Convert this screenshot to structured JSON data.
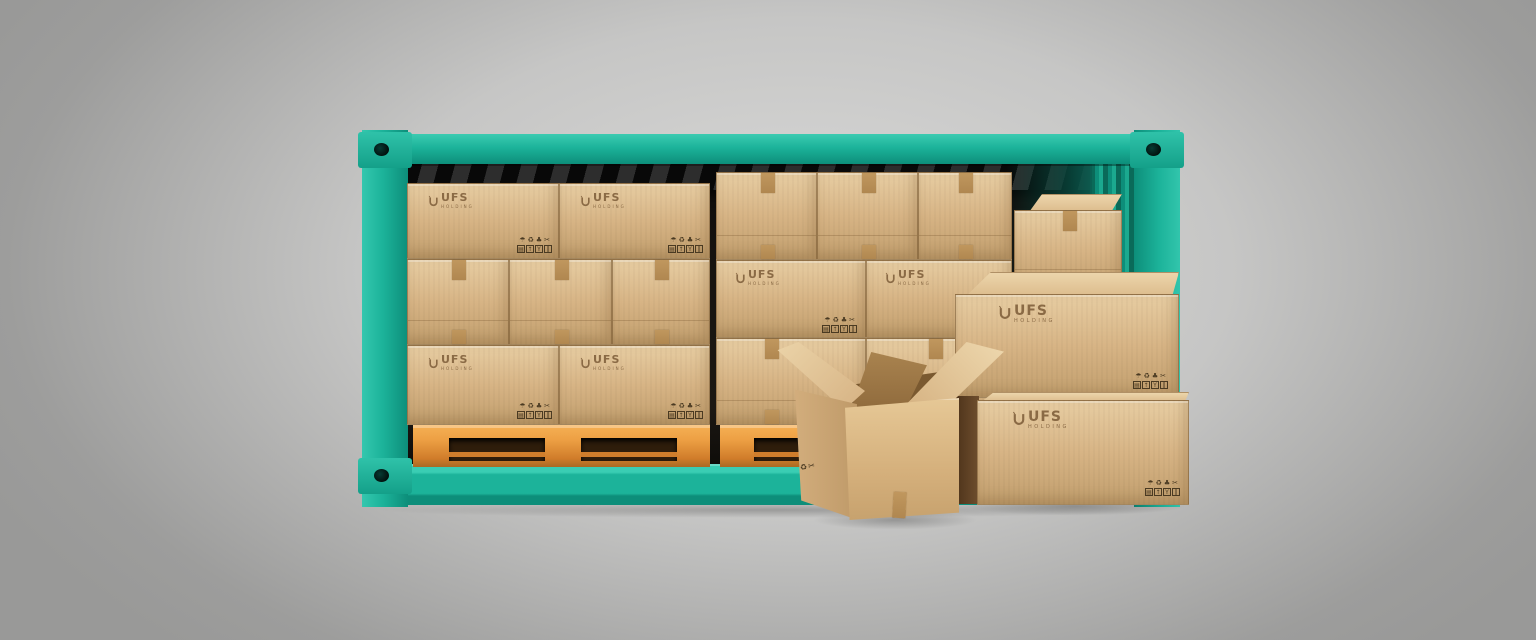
{
  "brand": {
    "logo_text": "UFS",
    "logo_tagline": "HOLDING",
    "logo_mark": "ribbon-u-icon"
  },
  "packaging_marks": {
    "row1_names": [
      "keep-dry-icon",
      "recycle-icon",
      "green-point-icon",
      "do-not-cut-icon"
    ],
    "row1_glyphs": "☂♻♣✂",
    "row2_names": [
      "stacking-limit-icon",
      "this-way-up-icon",
      "fragile-icon",
      "clamp-here-icon"
    ],
    "row2_glyphs": [
      "▤",
      "↑",
      "Y",
      "‖"
    ],
    "open_box_stamp_glyphs": "♻✂"
  },
  "colors": {
    "container_teal": "#1cb39a",
    "container_teal_light": "#3bcbb1",
    "container_teal_dark": "#0d8e7a",
    "container_teal_deep": "#0a6a59",
    "cardboard": "#d7b485",
    "cardboard_light": "#e7cda2",
    "cardboard_dark": "#c19e6d",
    "tape": "#c0975e",
    "pallet_orange": "#eda044",
    "pallet_dark": "#a96a24",
    "pallet_slot": "#2e1d0b",
    "interior": "#161310",
    "background_edge": "#9d9d9c",
    "background_center": "#dadad9",
    "logo_brown": "#8a6a45",
    "picto_ink": "#4a3a22"
  }
}
